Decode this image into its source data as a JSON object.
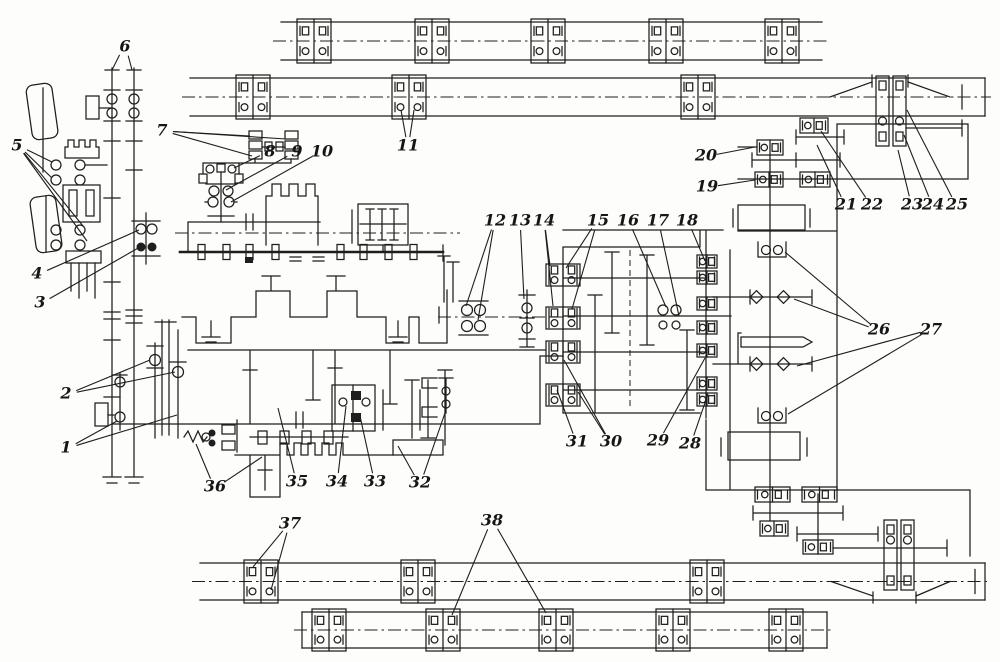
{
  "meta": {
    "kind": "kinematic-scheme line drawing",
    "ink": "#1e1e1e",
    "paper": "#fdfdfb",
    "width": 1000,
    "height": 662
  },
  "diagram": {
    "labels": [
      {
        "n": "1",
        "x": 66,
        "y": 448,
        "t": [
          [
            117,
            421
          ],
          [
            177,
            415
          ]
        ]
      },
      {
        "n": "2",
        "x": 66,
        "y": 394,
        "t": [
          [
            150,
            360
          ],
          [
            175,
            372
          ]
        ]
      },
      {
        "n": "3",
        "x": 40,
        "y": 303,
        "t": [
          [
            140,
            247
          ]
        ]
      },
      {
        "n": "4",
        "x": 37,
        "y": 274,
        "t": [
          [
            139,
            230
          ]
        ]
      },
      {
        "n": "5",
        "x": 17,
        "y": 146,
        "t": [
          [
            52,
            162
          ],
          [
            52,
            178
          ],
          [
            83,
            226
          ],
          [
            87,
            241
          ]
        ]
      },
      {
        "n": "6",
        "x": 125,
        "y": 47,
        "t": [
          [
            112,
            70
          ],
          [
            132,
            70
          ]
        ]
      },
      {
        "n": "7",
        "x": 162,
        "y": 131,
        "t": [
          [
            250,
            136
          ],
          [
            252,
            156
          ],
          [
            286,
            139
          ]
        ]
      },
      {
        "n": "8",
        "x": 270,
        "y": 152,
        "t": [
          [
            234,
            168
          ]
        ]
      },
      {
        "n": "9",
        "x": 297,
        "y": 152,
        "t": [
          [
            226,
            190
          ]
        ]
      },
      {
        "n": "10",
        "x": 322,
        "y": 152,
        "t": [
          [
            231,
            202
          ]
        ]
      },
      {
        "n": "11",
        "x": 408,
        "y": 146,
        "t": [
          [
            401,
            110
          ],
          [
            414,
            110
          ]
        ]
      },
      {
        "n": "12",
        "x": 495,
        "y": 221,
        "t": [
          [
            466,
            306
          ],
          [
            478,
            320
          ]
        ]
      },
      {
        "n": "13",
        "x": 520,
        "y": 221,
        "t": [
          [
            524,
            299
          ]
        ]
      },
      {
        "n": "14",
        "x": 544,
        "y": 221,
        "t": [
          [
            550,
            266
          ],
          [
            553,
            306
          ]
        ]
      },
      {
        "n": "15",
        "x": 598,
        "y": 221,
        "t": [
          [
            566,
            268
          ],
          [
            572,
            309
          ]
        ]
      },
      {
        "n": "16",
        "x": 628,
        "y": 221,
        "t": [
          [
            666,
            307
          ]
        ]
      },
      {
        "n": "17",
        "x": 658,
        "y": 221,
        "t": [
          [
            679,
            316
          ]
        ]
      },
      {
        "n": "18",
        "x": 687,
        "y": 221,
        "t": [
          [
            705,
            261
          ]
        ]
      },
      {
        "n": "19",
        "x": 707,
        "y": 187,
        "t": [
          [
            755,
            180
          ]
        ]
      },
      {
        "n": "20",
        "x": 706,
        "y": 156,
        "t": [
          [
            755,
            147
          ]
        ]
      },
      {
        "n": "21",
        "x": 846,
        "y": 205,
        "t": [
          [
            817,
            145
          ]
        ]
      },
      {
        "n": "22",
        "x": 872,
        "y": 205,
        "t": [
          [
            821,
            131
          ]
        ]
      },
      {
        "n": "23",
        "x": 912,
        "y": 205,
        "t": [
          [
            898,
            150
          ]
        ]
      },
      {
        "n": "24",
        "x": 933,
        "y": 205,
        "t": [
          [
            904,
            135
          ]
        ]
      },
      {
        "n": "25",
        "x": 957,
        "y": 205,
        "t": [
          [
            907,
            110
          ]
        ]
      },
      {
        "n": "26",
        "x": 879,
        "y": 330,
        "t": [
          [
            785,
            252
          ],
          [
            794,
            299
          ]
        ]
      },
      {
        "n": "27",
        "x": 931,
        "y": 330,
        "t": [
          [
            797,
            366
          ],
          [
            788,
            414
          ]
        ]
      },
      {
        "n": "28",
        "x": 690,
        "y": 444,
        "t": [
          [
            708,
            394
          ]
        ]
      },
      {
        "n": "29",
        "x": 658,
        "y": 441,
        "t": [
          [
            705,
            358
          ]
        ]
      },
      {
        "n": "30",
        "x": 611,
        "y": 442,
        "t": [
          [
            564,
            360
          ],
          [
            578,
            392
          ]
        ]
      },
      {
        "n": "31",
        "x": 577,
        "y": 442,
        "t": [
          [
            557,
            390
          ]
        ]
      },
      {
        "n": "32",
        "x": 420,
        "y": 483,
        "t": [
          [
            398,
            446
          ],
          [
            446,
            410
          ]
        ]
      },
      {
        "n": "33",
        "x": 375,
        "y": 482,
        "t": [
          [
            360,
            416
          ]
        ]
      },
      {
        "n": "34",
        "x": 337,
        "y": 482,
        "t": [
          [
            346,
            406
          ]
        ]
      },
      {
        "n": "35",
        "x": 297,
        "y": 482,
        "t": [
          [
            278,
            408
          ]
        ]
      },
      {
        "n": "36",
        "x": 215,
        "y": 487,
        "t": [
          [
            196,
            444
          ],
          [
            262,
            457
          ]
        ]
      },
      {
        "n": "37",
        "x": 290,
        "y": 524,
        "t": [
          [
            253,
            567
          ],
          [
            271,
            590
          ]
        ]
      },
      {
        "n": "38",
        "x": 492,
        "y": 521,
        "t": [
          [
            452,
            615
          ],
          [
            546,
            613
          ]
        ]
      }
    ],
    "rails": [
      {
        "id": "guideway-top-outer",
        "x1": 281,
        "x2": 822,
        "yTop": 22,
        "yBot": 60,
        "capL": false,
        "capR": false,
        "blocks": [
          314,
          432,
          548,
          666,
          782
        ]
      },
      {
        "id": "guideway-top-inner",
        "x1": 190,
        "x2": 985,
        "yTop": 78,
        "yBot": 116,
        "capL": false,
        "capR": true,
        "blocks": [
          253,
          409,
          698
        ],
        "tall": {
          "x": 876,
          "y1": 76,
          "y2": 146,
          "cy": 121
        },
        "slantL": [
          830,
          872
        ],
        "slantR": [
          908,
          950
        ],
        "slantDir": "up",
        "endTick": 962
      },
      {
        "id": "guideway-bottom-inner",
        "x1": 200,
        "x2": 985,
        "yTop": 563,
        "yBot": 600,
        "capL": false,
        "capR": true,
        "blocks": [
          261,
          418,
          707
        ],
        "tall": {
          "x": 884,
          "y1": 520,
          "y2": 590,
          "cy": 540
        },
        "slantL": [
          831,
          873
        ],
        "slantR": [
          916,
          950
        ],
        "slantDir": "down",
        "endTick": 975
      },
      {
        "id": "guideway-bottom-outer",
        "x1": 302,
        "x2": 827,
        "yTop": 612,
        "yBot": 648,
        "capL": true,
        "capR": true,
        "blocks": [
          329,
          443,
          556,
          673,
          786
        ]
      }
    ],
    "bearing_units": [
      {
        "x": 546,
        "y": 264,
        "w": 34,
        "h": 22
      },
      {
        "x": 546,
        "y": 307,
        "w": 34,
        "h": 22
      },
      {
        "x": 546,
        "y": 341,
        "w": 34,
        "h": 22
      },
      {
        "x": 546,
        "y": 384,
        "w": 34,
        "h": 22
      },
      {
        "x": 697,
        "y": 255,
        "w": 20,
        "h": 13
      },
      {
        "x": 697,
        "y": 271,
        "w": 20,
        "h": 13
      },
      {
        "x": 697,
        "y": 297,
        "w": 20,
        "h": 13
      },
      {
        "x": 697,
        "y": 321,
        "w": 20,
        "h": 13
      },
      {
        "x": 697,
        "y": 344,
        "w": 20,
        "h": 13
      },
      {
        "x": 697,
        "y": 377,
        "w": 20,
        "h": 13
      },
      {
        "x": 697,
        "y": 393,
        "w": 20,
        "h": 13
      },
      {
        "x": 757,
        "y": 140,
        "w": 26,
        "h": 15
      },
      {
        "x": 800,
        "y": 118,
        "w": 28,
        "h": 15
      },
      {
        "x": 755,
        "y": 172,
        "w": 28,
        "h": 15
      },
      {
        "x": 800,
        "y": 172,
        "w": 30,
        "h": 15
      },
      {
        "x": 755,
        "y": 487,
        "w": 35,
        "h": 15
      },
      {
        "x": 802,
        "y": 487,
        "w": 35,
        "h": 15
      },
      {
        "x": 760,
        "y": 521,
        "w": 28,
        "h": 15
      },
      {
        "x": 803,
        "y": 540,
        "w": 30,
        "h": 14
      }
    ]
  }
}
